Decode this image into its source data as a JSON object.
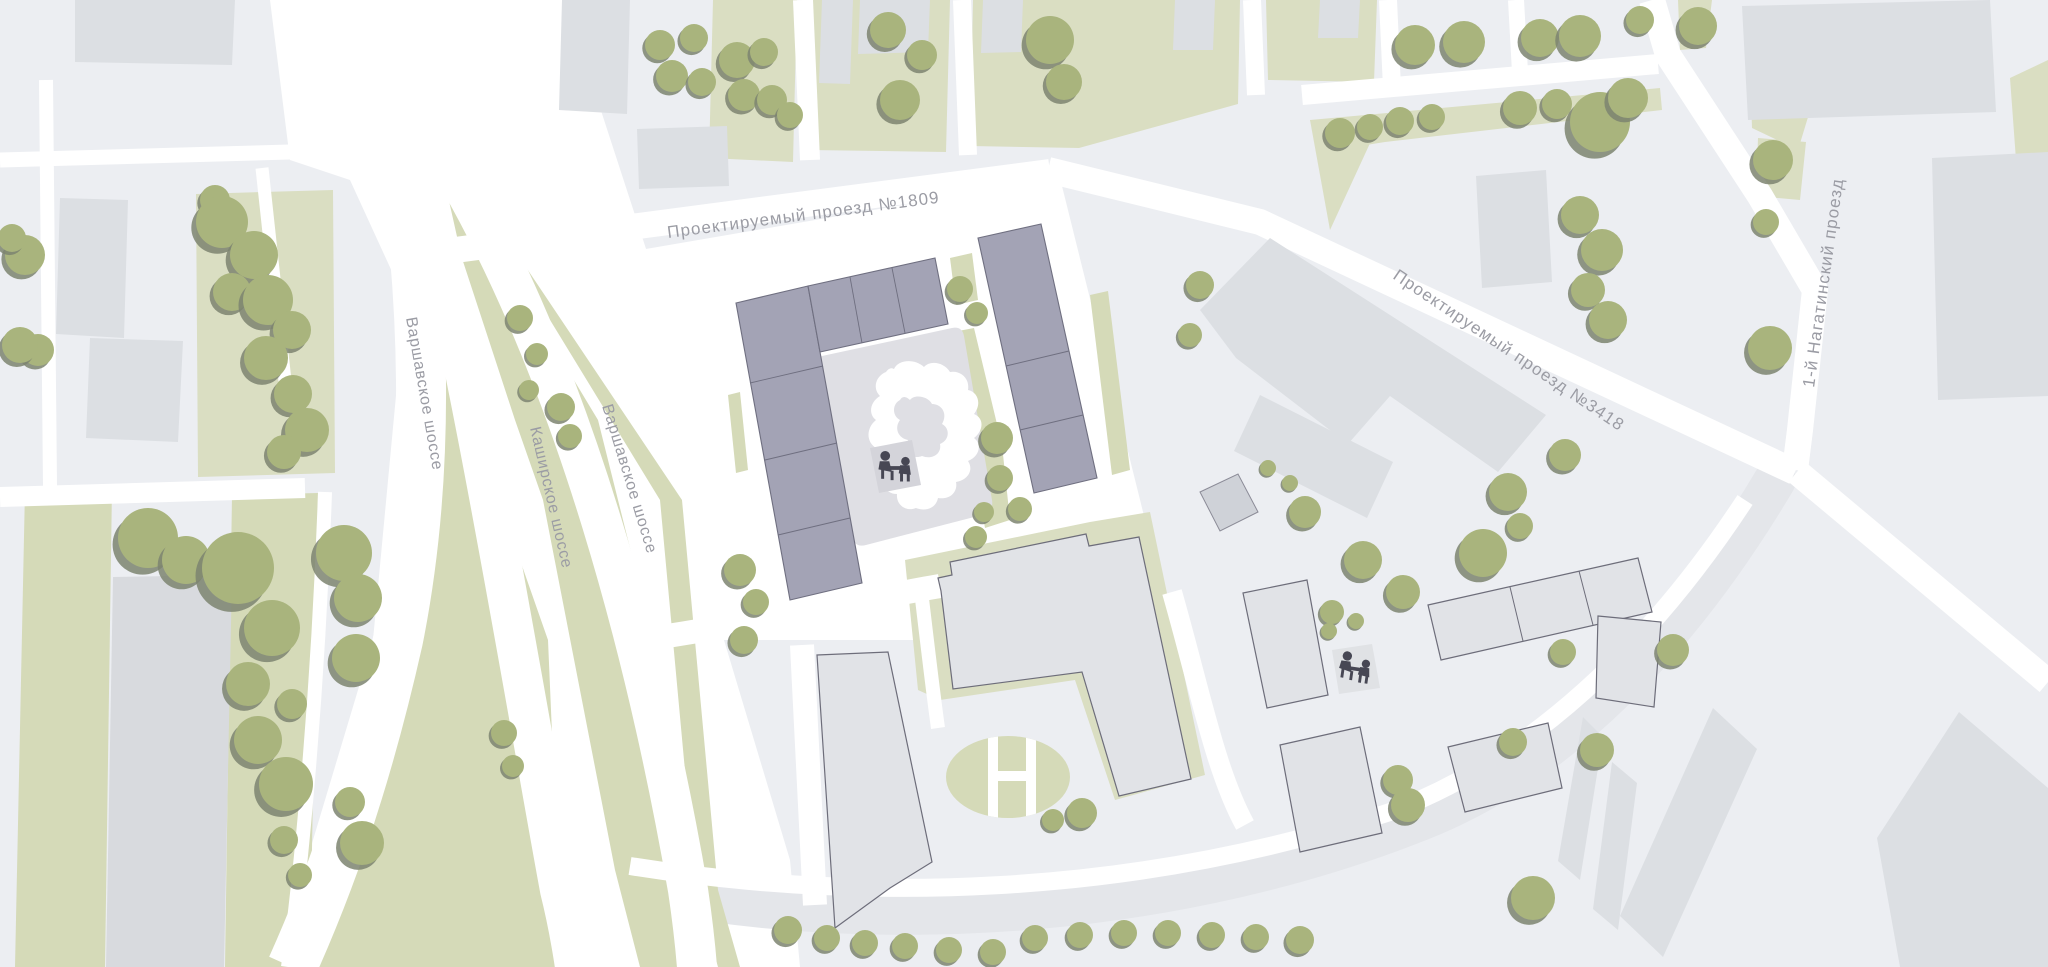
{
  "map": {
    "type": "site-plan",
    "streets": {
      "pr1809": "Проектируемый проезд №1809",
      "pr3418": "Проектируемый проезд №3418",
      "varshavskoye": "Варшавское шоссе",
      "kashirskoye": "Каширское шоссе",
      "nagatinsky": "1-й Нагатинский проезд"
    },
    "icons": {
      "playground": "playground-icon",
      "tree": "tree-icon"
    },
    "colors": {
      "background": "#eceef2",
      "road": "#ffffff",
      "road_secondary": "#e4e6ea",
      "greenery": "#d5dab8",
      "greenery_light": "#dadec2",
      "tree": "#a9b47d",
      "tree_shadow": "#7d8470",
      "building": "#dcdfe3",
      "building_dark": "#d8dade",
      "building_outlined": "#e1e3e7",
      "building_outline": "#6d6d7a",
      "project_building": "#a3a3b5",
      "project_building_outline": "#6f6f80",
      "courtyard": "#dfdfe4",
      "courtyard_pad": "#d4d4da",
      "playground_figures": "#474754",
      "street_label": "#9b9ca4"
    }
  }
}
